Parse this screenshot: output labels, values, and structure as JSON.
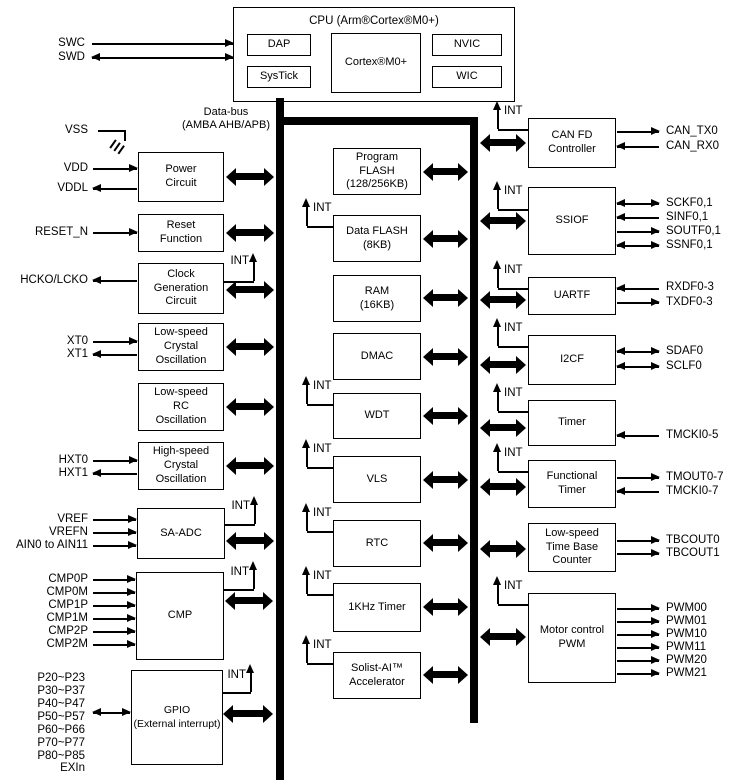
{
  "cpu": {
    "title": "CPU (Arm®Cortex®M0+)",
    "dap": "DAP",
    "systick": "SysTick",
    "core": "Cortex®M0+",
    "nvic": "NVIC",
    "wic": "WIC"
  },
  "bus": {
    "label": "Data-bus\n(AMBA AHB/APB)",
    "int_label": "INT"
  },
  "left_blocks": {
    "power": "Power\nCircuit",
    "reset": "Reset\nFunction",
    "clock": "Clock\nGeneration\nCircuit",
    "ls_crystal": "Low-speed\nCrystal\nOscillation",
    "ls_rc": "Low-speed\nRC\nOscillation",
    "hs_crystal": "High-speed\nCrystal\nOscillation",
    "sa_adc": "SA-ADC",
    "cmp": "CMP",
    "gpio": "GPIO\n(External interrupt)"
  },
  "mid_blocks": {
    "program_flash": "Program\nFLASH\n(128/256KB)",
    "data_flash": "Data FLASH\n(8KB)",
    "ram": "RAM\n(16KB)",
    "dmac": "DMAC",
    "wdt": "WDT",
    "vls": "VLS",
    "rtc": "RTC",
    "khz_timer": "1KHz Timer",
    "solist": "Solist-AI™\nAccelerator"
  },
  "right_blocks": {
    "canfd": "CAN FD\nController",
    "ssiof": "SSIOF",
    "uartf": "UARTF",
    "i2cf": "I2CF",
    "timer": "Timer",
    "ftimer": "Functional\nTimer",
    "tbc": "Low-speed\nTime Base\nCounter",
    "pwm": "Motor control\nPWM"
  },
  "pins": {
    "swc": "SWC",
    "swd": "SWD",
    "vss": "VSS",
    "vdd": "VDD",
    "vddl": "VDDL",
    "reset_n": "RESET_N",
    "hcko": "HCKO/LCKO",
    "xt0": "XT0",
    "xt1": "XT1",
    "hxt0": "HXT0",
    "hxt1": "HXT1",
    "vref": "VREF",
    "vrefn": "VREFN",
    "ain": "AIN0 to AIN11",
    "cmp0p": "CMP0P",
    "cmp0m": "CMP0M",
    "cmp1p": "CMP1P",
    "cmp1m": "CMP1M",
    "cmp2p": "CMP2P",
    "cmp2m": "CMP2M",
    "p20": "P20~P23",
    "p30": "P30~P37",
    "p40": "P40~P47",
    "p50": "P50~P57",
    "p60": "P60~P66",
    "p70": "P70~P77",
    "p80": "P80~P85",
    "exin": "EXIn",
    "can_tx0": "CAN_TX0",
    "can_rx0": "CAN_RX0",
    "sckf": "SCKF0,1",
    "sinf": "SINF0,1",
    "soutf": "SOUTF0,1",
    "ssnf": "SSNF0,1",
    "rxdf": "RXDF0-3",
    "txdf": "TXDF0-3",
    "sdaf0": "SDAF0",
    "sclf0": "SCLF0",
    "tmcki05": "TMCKI0-5",
    "tmout": "TMOUT0-7",
    "tmcki07": "TMCKI0-7",
    "tbcout0": "TBCOUT0",
    "tbcout1": "TBCOUT1",
    "pwm00": "PWM00",
    "pwm01": "PWM01",
    "pwm10": "PWM10",
    "pwm11": "PWM11",
    "pwm20": "PWM20",
    "pwm21": "PWM21"
  }
}
